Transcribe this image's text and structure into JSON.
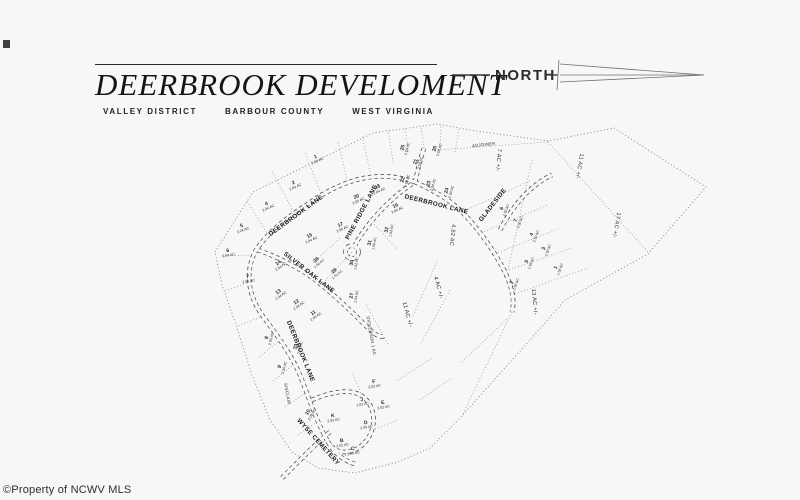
{
  "page": {
    "background": "#f7f7f5",
    "watermark": "©Property of NCWV MLS"
  },
  "header": {
    "title": "DEERBROOK DEVELOMENT",
    "subtitle": {
      "district": "VALLEY DISTRICT",
      "county": "BARBOUR COUNTY",
      "state": "WEST VIRGINIA"
    },
    "north_label": "NORTH"
  },
  "map": {
    "road_names": [
      "DEERBROOK LANE",
      "PINE RIDGE LANE",
      "SILVER OAK LANE",
      "GLADESIDE",
      "WYSE CEMETERY"
    ],
    "road_labels": [
      {
        "text": "DEERBROOK LANE",
        "x": 297,
        "y": 217,
        "rot": -36
      },
      {
        "text": "PINE RIDGE LANE",
        "x": 363,
        "y": 213,
        "rot": -62
      },
      {
        "text": "DEERBROOK LANE",
        "x": 436,
        "y": 206,
        "rot": 14
      },
      {
        "text": "SILVER OAK LANE",
        "x": 308,
        "y": 274,
        "rot": 38
      },
      {
        "text": "DEERBROOK LANE",
        "x": 299,
        "y": 352,
        "rot": 68
      },
      {
        "text": "WYSE CEMETERY",
        "x": 317,
        "y": 443,
        "rot": 48
      },
      {
        "text": "GLADESIDE",
        "x": 494,
        "y": 206,
        "rot": -52
      }
    ],
    "parcels": [
      {
        "id": "1",
        "acreage": "2.50 AC",
        "x": 316,
        "y": 158,
        "rot": -25
      },
      {
        "id": "2",
        "acreage": "2.04 AC",
        "x": 294,
        "y": 184,
        "rot": -25
      },
      {
        "id": "4",
        "acreage": "2.04 AC",
        "x": 267,
        "y": 205,
        "rot": -25
      },
      {
        "id": "5",
        "acreage": "2.04 AC",
        "x": 242,
        "y": 227,
        "rot": -20
      },
      {
        "id": "6",
        "acreage": "2.04 AC",
        "x": 228,
        "y": 252,
        "rot": -10
      },
      {
        "id": "7",
        "acreage": "2.06 AC",
        "x": 248,
        "y": 278,
        "rot": -10
      },
      {
        "id": "8",
        "acreage": "2.03 AC",
        "x": 268,
        "y": 338,
        "rot": -75
      },
      {
        "id": "9",
        "acreage": "2.04 AC",
        "x": 281,
        "y": 367,
        "rot": -75
      },
      {
        "id": "10",
        "acreage": "2.08 AC",
        "x": 309,
        "y": 413,
        "rot": -60
      },
      {
        "id": "33",
        "acreage": "2.07 AC",
        "x": 297,
        "y": 347,
        "rot": -75
      },
      {
        "id": "15",
        "acreage": "2.04 AC",
        "x": 310,
        "y": 237,
        "rot": -25
      },
      {
        "id": "17",
        "acreage": "2.50 AC",
        "x": 341,
        "y": 226,
        "rot": -25
      },
      {
        "id": "14",
        "acreage": "2.04 AC",
        "x": 279,
        "y": 264,
        "rot": -35
      },
      {
        "id": "13",
        "acreage": "2.04 AC",
        "x": 279,
        "y": 293,
        "rot": -35
      },
      {
        "id": "12",
        "acreage": "2.04 AC",
        "x": 297,
        "y": 303,
        "rot": -35
      },
      {
        "id": "11",
        "acreage": "2.05 AC",
        "x": 314,
        "y": 314,
        "rot": -35
      },
      {
        "id": "28",
        "acreage": "1.50 AC",
        "x": 317,
        "y": 261,
        "rot": -40
      },
      {
        "id": "29",
        "acreage": "1.51 AC",
        "x": 335,
        "y": 272,
        "rot": -40
      },
      {
        "id": "30",
        "acreage": "1.52 AC",
        "x": 353,
        "y": 263,
        "rot": -80
      },
      {
        "id": "31",
        "acreage": "1.50 AC",
        "x": 371,
        "y": 243,
        "rot": -80
      },
      {
        "id": "32",
        "acreage": "1.53 AC",
        "x": 388,
        "y": 230,
        "rot": -80
      },
      {
        "id": "27",
        "acreage": "1.54 AC",
        "x": 353,
        "y": 296,
        "rot": -80
      },
      {
        "id": "20",
        "acreage": "2.05 AC",
        "x": 357,
        "y": 198,
        "rot": -25
      },
      {
        "id": "18",
        "acreage": "2.04 AC",
        "x": 378,
        "y": 188,
        "rot": -25
      },
      {
        "id": "16",
        "acreage": "2.04 AC",
        "x": 396,
        "y": 207,
        "rot": -25
      },
      {
        "id": "21",
        "acreage": "2.50 AC",
        "x": 417,
        "y": 162,
        "rot": -75
      },
      {
        "id": "22",
        "acreage": "2.04 AC",
        "x": 404,
        "y": 180,
        "rot": -75
      },
      {
        "id": "23",
        "acreage": "2.04 AC",
        "x": 430,
        "y": 184,
        "rot": -75
      },
      {
        "id": "24",
        "acreage": "2.04 AC",
        "x": 448,
        "y": 191,
        "rot": -75
      },
      {
        "id": "25",
        "acreage": "2.50 AC",
        "x": 404,
        "y": 148,
        "rot": -75
      },
      {
        "id": "26",
        "acreage": "2.50 AC",
        "x": 436,
        "y": 149,
        "rot": -75
      },
      {
        "id": "6",
        "acreage": "2.50 AC",
        "x": 503,
        "y": 209,
        "rot": -70
      },
      {
        "id": "7",
        "acreage": "2.50 AC",
        "x": 517,
        "y": 221,
        "rot": -70
      },
      {
        "id": "4",
        "acreage": "2.50 AC",
        "x": 533,
        "y": 235,
        "rot": -70
      },
      {
        "id": "3",
        "acreage": "1.50 AC",
        "x": 545,
        "y": 249,
        "rot": -70
      },
      {
        "id": "5",
        "acreage": "1.56 AC",
        "x": 528,
        "y": 262,
        "rot": -70
      },
      {
        "id": "1",
        "acreage": "1.56 AC",
        "x": 557,
        "y": 268,
        "rot": -70
      },
      {
        "id": "2",
        "acreage": "2.50 AC",
        "x": 513,
        "y": 283,
        "rot": -70
      },
      {
        "id": "J",
        "acreage": "1.02 AC",
        "x": 362,
        "y": 401,
        "rot": -10
      },
      {
        "id": "K",
        "acreage": "2.02 AC",
        "x": 333,
        "y": 417,
        "rot": -10
      },
      {
        "id": "B",
        "acreage": "2.02 AC",
        "x": 342,
        "y": 442,
        "rot": -10
      },
      {
        "id": "C",
        "acreage": "2.00 AC",
        "x": 353,
        "y": 450,
        "rot": -10
      },
      {
        "id": "D",
        "acreage": "2.00 AC",
        "x": 366,
        "y": 424,
        "rot": -10
      },
      {
        "id": "E",
        "acreage": "2.02 AC",
        "x": 383,
        "y": 404,
        "rot": -10
      },
      {
        "id": "F",
        "acreage": "2.02 AC",
        "x": 374,
        "y": 383,
        "rot": -10
      }
    ],
    "area_labels": [
      {
        "text": "4.52 AC",
        "x": 451,
        "y": 235,
        "rot": 95
      },
      {
        "text": "7 AC +/-",
        "x": 497,
        "y": 160,
        "rot": 95
      },
      {
        "text": "11 AC +/-",
        "x": 578,
        "y": 166,
        "rot": 100
      },
      {
        "text": "17 AC +/-",
        "x": 615,
        "y": 225,
        "rot": 100
      },
      {
        "text": "4 AC +/-",
        "x": 437,
        "y": 288,
        "rot": 75
      },
      {
        "text": "11 AC +/-",
        "x": 406,
        "y": 315,
        "rot": 75
      },
      {
        "text": "13 AC +/-",
        "x": 533,
        "y": 302,
        "rot": 85
      }
    ],
    "owner_labels": [
      {
        "text": "ADJOINER",
        "x": 484,
        "y": 146,
        "rot": -6
      },
      {
        "text": "SINCLAIR",
        "x": 286,
        "y": 394,
        "rot": 80
      },
      {
        "text": "DICKERSON 1 AC",
        "x": 370,
        "y": 336,
        "rot": 80
      }
    ]
  }
}
